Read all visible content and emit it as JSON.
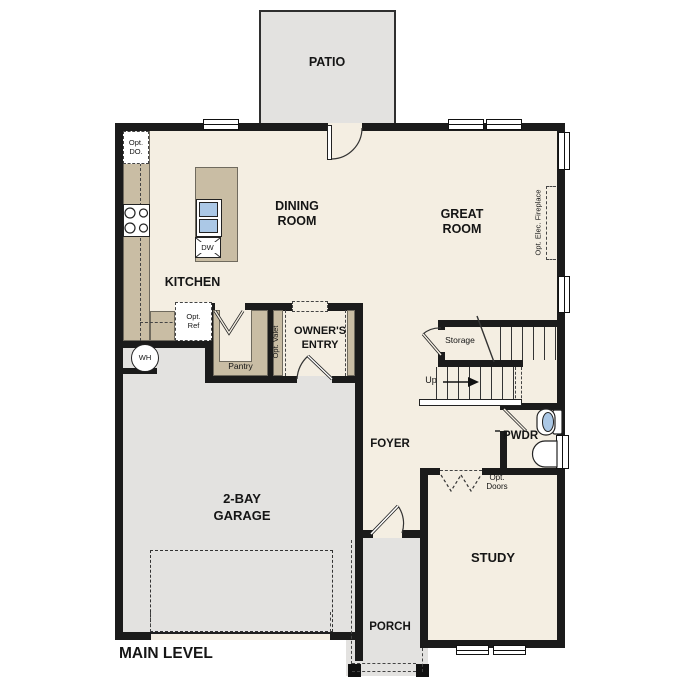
{
  "plan": {
    "title": "MAIN LEVEL",
    "colors": {
      "interior": "#f4eee2",
      "outdoor_concrete": "#e3e2e0",
      "counter": "#c9bda4",
      "wall": "#1b1b1b",
      "fixture_blue": "#abc8e6"
    },
    "rooms": {
      "patio": "PATIO",
      "dining": "DINING\nROOM",
      "great": "GREAT\nROOM",
      "kitchen": "KITCHEN",
      "owners_entry": "OWNER'S\nENTRY",
      "garage": "2-BAY\nGARAGE",
      "foyer": "FOYER",
      "storage": "Storage",
      "pwdr": "PWDR",
      "study": "STUDY",
      "porch": "PORCH"
    },
    "annotations": {
      "opt_do": "Opt.\nDO.",
      "opt_ref": "Opt.\nRef",
      "dw": "DW",
      "wh": "WH",
      "pantry": "Pantry",
      "opt_valet": "Opt. Valet",
      "up": "Up",
      "opt_elec_fireplace": "Opt. Elec. Fireplace",
      "opt_doors": "Opt.\nDoors"
    }
  }
}
